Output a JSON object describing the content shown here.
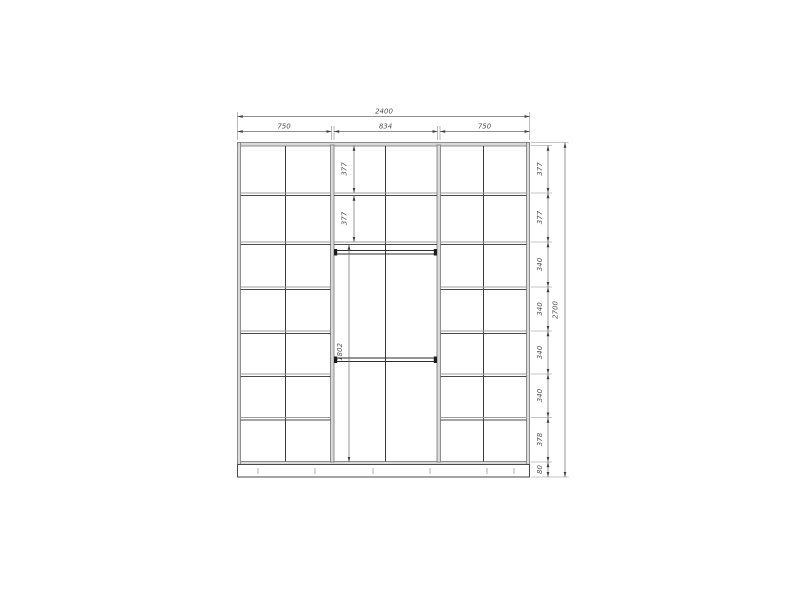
{
  "drawing": {
    "name": "wardrobe-front-elevation",
    "dimensions": {
      "overall_width": "2400",
      "overall_height": "2700",
      "top_sections": [
        "750",
        "834",
        "750"
      ],
      "right_chain": [
        "377",
        "377",
        "340",
        "340",
        "340",
        "340",
        "378",
        "80"
      ],
      "middle_upper": [
        "377",
        "377"
      ],
      "middle_hanging": "1802"
    },
    "colors": {
      "background": "#ffffff",
      "structure_line": "#3a3a3a",
      "panel_fill": "#d9d9d9",
      "dimension_line": "#6b6b6b",
      "dimension_text": "#4f4f4f"
    }
  }
}
